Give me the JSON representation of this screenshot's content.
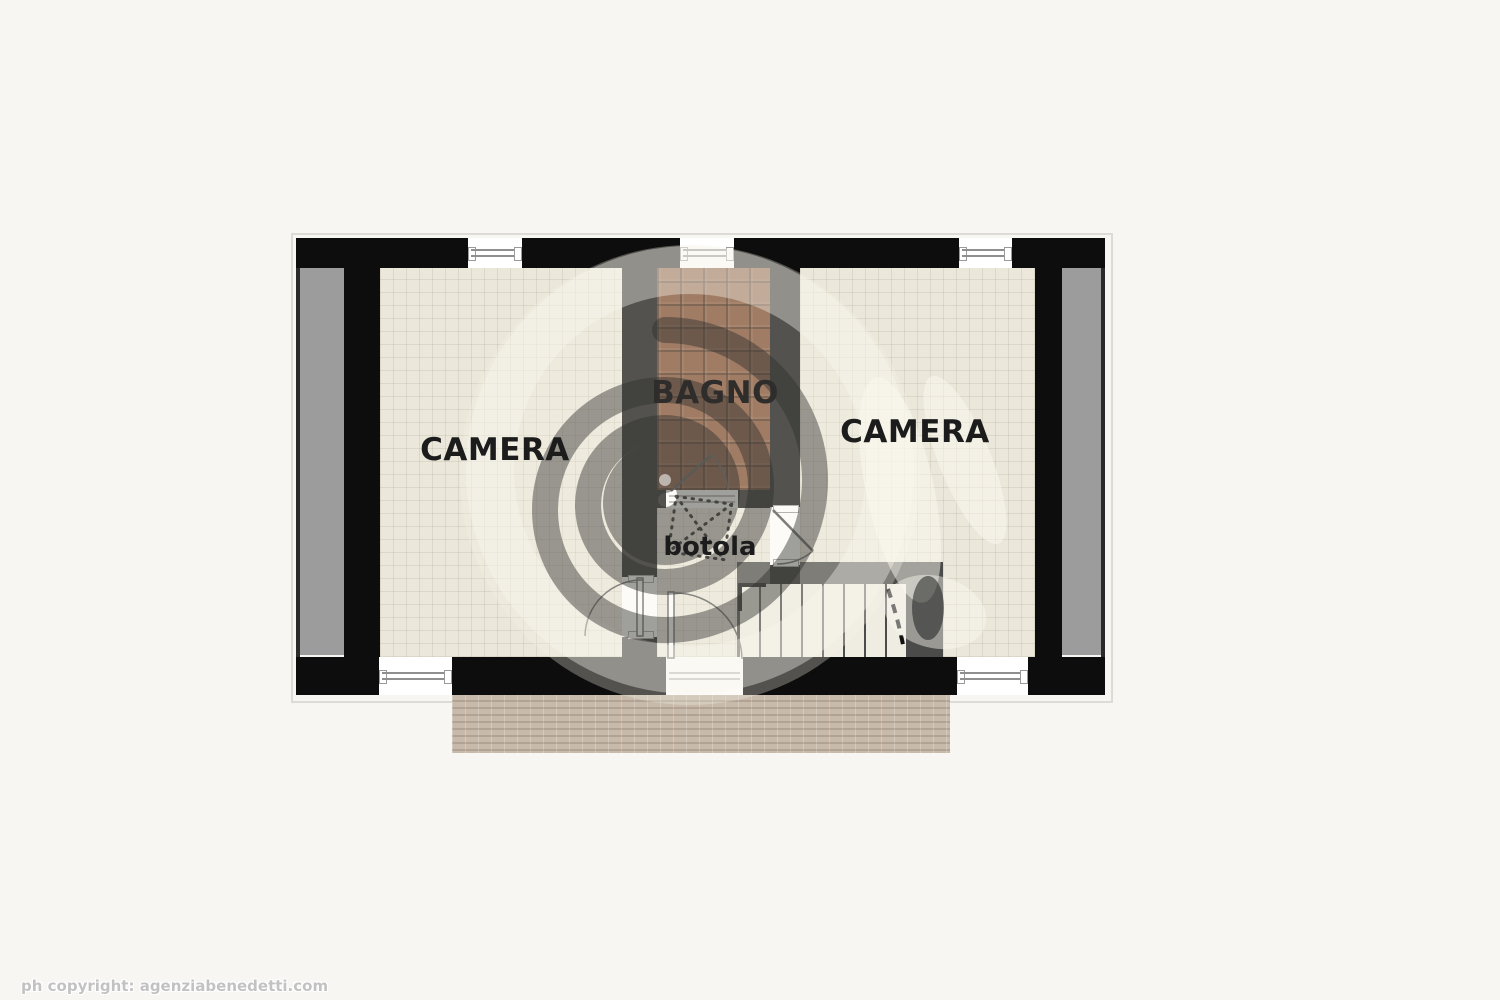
{
  "page": {
    "background": "#f7f6f3"
  },
  "floorplan": {
    "rooms": [
      {
        "id": "camera-left",
        "label": "CAMERA"
      },
      {
        "id": "bagno",
        "label": "BAGNO"
      },
      {
        "id": "camera-right",
        "label": "CAMERA"
      },
      {
        "id": "botola",
        "label": "botola"
      }
    ],
    "colors": {
      "page-bg": "#f7f6f3",
      "wall": "#0d0d0d",
      "floor": "#ebe8db",
      "bagno-tile": "#7b4a2f",
      "balcony": "#9c9c9c",
      "stair-surround": "#4b4b49",
      "tread": "#efece2",
      "tread-line": "#4c4c4c",
      "terrace-brick": "#c7baab",
      "terrace-joint": "#b1a293",
      "label": "#1c1c1c",
      "copyright": "#c2c2c2"
    }
  },
  "footer": {
    "copyright": "ph copyright: agenziabenedetti.com"
  }
}
